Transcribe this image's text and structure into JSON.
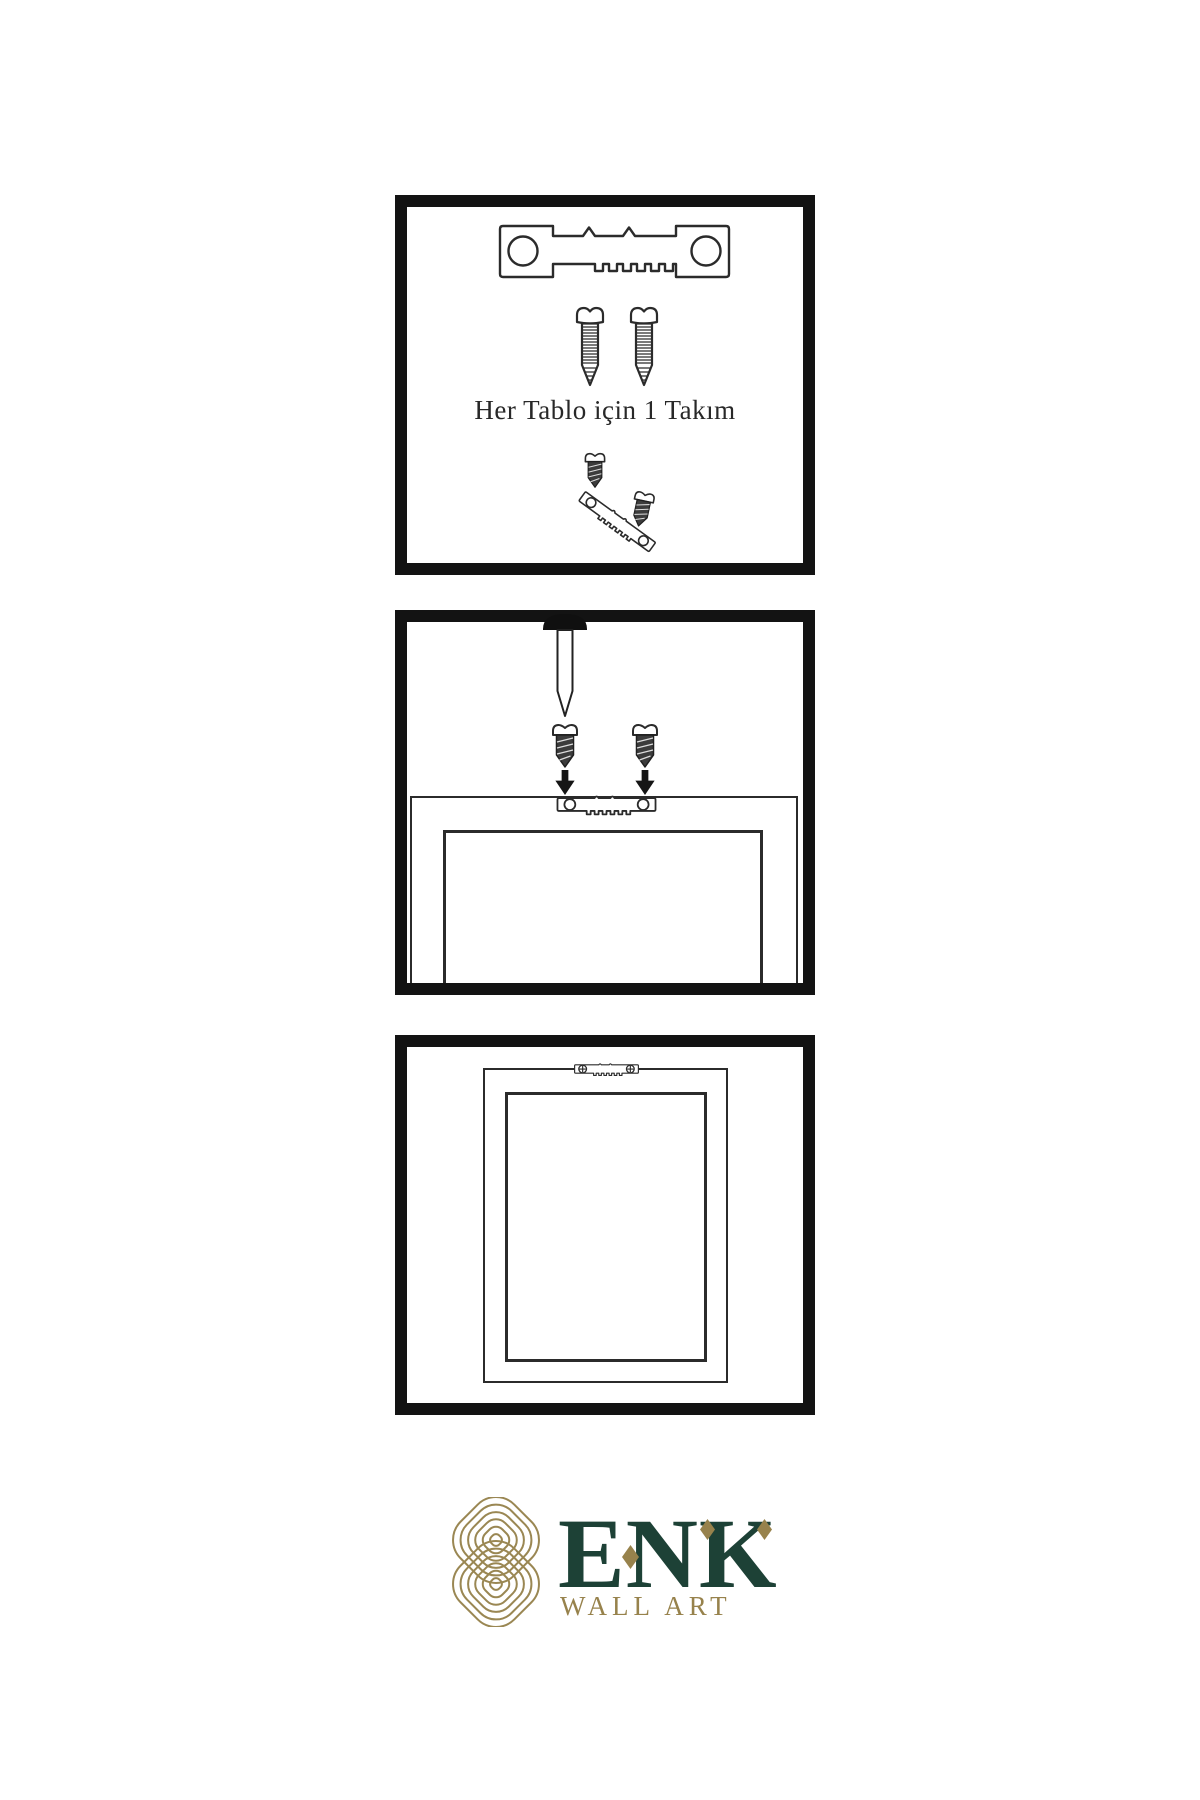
{
  "page": {
    "background": "#ffffff"
  },
  "colors": {
    "ink": "#2b2b2b",
    "panel_border": "#131313",
    "screw_dark_fill": "#3c3c3c",
    "brand_green": "#1d4136",
    "brand_gold": "#97824c"
  },
  "panels": {
    "kit": {
      "caption": "Her Tablo için 1 Takım",
      "items": [
        "sawtooth-hanger",
        "screw",
        "screw",
        "screw-dark",
        "angled-sawtooth-hanger",
        "screw-dark"
      ]
    },
    "wall_mount": {
      "items": [
        "wall-nail",
        "screw-dark",
        "screw-dark",
        "arrow-down",
        "arrow-down",
        "sawtooth-hanger",
        "frame-back"
      ]
    },
    "hung_frame": {
      "items": [
        "sawtooth-hanger-screwed",
        "frame-front",
        "frame-mat"
      ]
    }
  },
  "icons": {
    "sawtooth_hanger": "sawtooth-hanger-icon",
    "screw_light": "screw-icon",
    "screw_dark": "dark-screw-icon",
    "wall_nail": "nail-icon",
    "arrow_down": "arrow-down-icon",
    "knot": "knot-logo-icon"
  },
  "logo": {
    "brand": "ENK",
    "subtitle": "WALL ART"
  }
}
